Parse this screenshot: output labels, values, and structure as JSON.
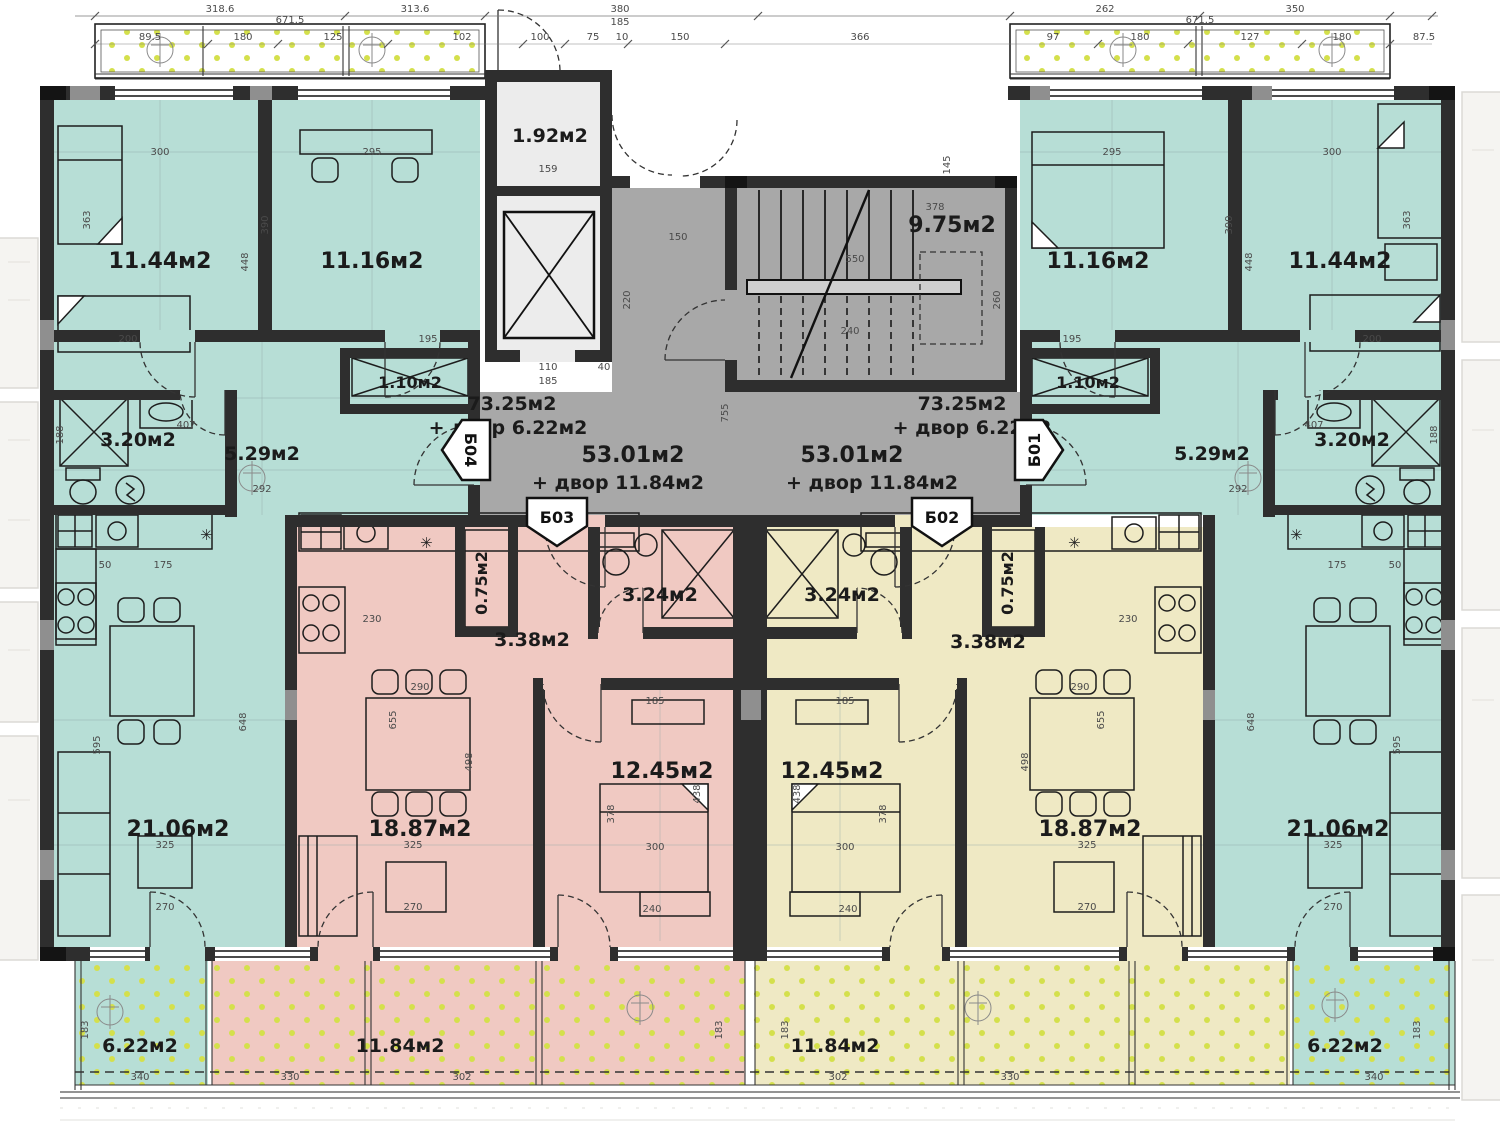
{
  "title": "apartment-floor-plan",
  "colors": {
    "teal_apartment": "#b7ded6",
    "pink_apartment": "#f0c9c2",
    "yellow_apartment": "#efe9c4",
    "common_area_gray": "#a8a8a8",
    "wall": "#2e2e2e",
    "terrace_dot_green": "#d4e04c"
  },
  "rooms": [
    {
      "label": "11.44м2"
    },
    {
      "label": "11.16м2"
    },
    {
      "label": "1.92м2"
    },
    {
      "label": "9.75м2"
    },
    {
      "label": "11.16м2"
    },
    {
      "label": "11.44м2"
    },
    {
      "label": "1.10м2"
    },
    {
      "label": "1.10м2"
    },
    {
      "label": "3.20м2"
    },
    {
      "label": "5.29м2"
    },
    {
      "label": "73.25м2"
    },
    {
      "label": "+ двор 6.22м2"
    },
    {
      "label": "53.01м2"
    },
    {
      "label": "+ двор 11.84м2"
    },
    {
      "label": "53.01м2"
    },
    {
      "label": "+ двор 11.84м2"
    },
    {
      "label": "73.25м2"
    },
    {
      "label": "+ двор 6.22м2"
    },
    {
      "label": "5.29м2"
    },
    {
      "label": "3.20м2"
    },
    {
      "label": "0.75м2"
    },
    {
      "label": "0.75м2"
    },
    {
      "label": "3.24м2"
    },
    {
      "label": "3.24м2"
    },
    {
      "label": "3.38м2"
    },
    {
      "label": "3.38м2"
    },
    {
      "label": "12.45м2"
    },
    {
      "label": "12.45м2"
    },
    {
      "label": "18.87м2"
    },
    {
      "label": "18.87м2"
    },
    {
      "label": "21.06м2"
    },
    {
      "label": "21.06м2"
    },
    {
      "label": "6.22м2"
    },
    {
      "label": "11.84м2"
    },
    {
      "label": "11.84м2"
    },
    {
      "label": "6.22м2"
    }
  ],
  "entrances": [
    {
      "label": "Б04"
    },
    {
      "label": "Б03"
    },
    {
      "label": "Б02"
    },
    {
      "label": "Б01"
    }
  ],
  "dims": [
    {
      "t": "318.6",
      "x": 220,
      "y": 12
    },
    {
      "t": "313.6",
      "x": 415,
      "y": 12
    },
    {
      "t": "380",
      "x": 620,
      "y": 12
    },
    {
      "t": "262",
      "x": 1105,
      "y": 12
    },
    {
      "t": "350",
      "x": 1295,
      "y": 12
    },
    {
      "t": "671.5",
      "x": 290,
      "y": 23
    },
    {
      "t": "185",
      "x": 620,
      "y": 25
    },
    {
      "t": "671.5",
      "x": 1200,
      "y": 23
    },
    {
      "t": "89.5",
      "x": 150,
      "y": 40
    },
    {
      "t": "180",
      "x": 243,
      "y": 40
    },
    {
      "t": "125",
      "x": 333,
      "y": 40
    },
    {
      "t": "102",
      "x": 462,
      "y": 40
    },
    {
      "t": "100",
      "x": 540,
      "y": 40
    },
    {
      "t": "75",
      "x": 593,
      "y": 40
    },
    {
      "t": "10",
      "x": 622,
      "y": 40
    },
    {
      "t": "150",
      "x": 680,
      "y": 40
    },
    {
      "t": "366",
      "x": 860,
      "y": 40
    },
    {
      "t": "97",
      "x": 1053,
      "y": 40
    },
    {
      "t": "180",
      "x": 1140,
      "y": 40
    },
    {
      "t": "127",
      "x": 1250,
      "y": 40
    },
    {
      "t": "180",
      "x": 1342,
      "y": 40
    },
    {
      "t": "87.5",
      "x": 1424,
      "y": 40
    },
    {
      "t": "300",
      "x": 160,
      "y": 155
    },
    {
      "t": "295",
      "x": 372,
      "y": 155
    },
    {
      "t": "295",
      "x": 1112,
      "y": 155
    },
    {
      "t": "300",
      "x": 1332,
      "y": 155
    },
    {
      "t": "363",
      "x": 90,
      "y": 220,
      "r": 1
    },
    {
      "t": "390",
      "x": 268,
      "y": 225,
      "r": 1
    },
    {
      "t": "448",
      "x": 248,
      "y": 262,
      "r": 1
    },
    {
      "t": "448",
      "x": 1252,
      "y": 262,
      "r": 1
    },
    {
      "t": "390",
      "x": 1232,
      "y": 225,
      "r": 1
    },
    {
      "t": "363",
      "x": 1410,
      "y": 220,
      "r": 1
    },
    {
      "t": "200",
      "x": 128,
      "y": 342
    },
    {
      "t": "195",
      "x": 428,
      "y": 342
    },
    {
      "t": "195",
      "x": 1072,
      "y": 342
    },
    {
      "t": "200",
      "x": 1372,
      "y": 342
    },
    {
      "t": "159",
      "x": 548,
      "y": 172
    },
    {
      "t": "145",
      "x": 950,
      "y": 165,
      "r": 1
    },
    {
      "t": "550",
      "x": 855,
      "y": 262
    },
    {
      "t": "240",
      "x": 850,
      "y": 334
    },
    {
      "t": "378",
      "x": 935,
      "y": 210
    },
    {
      "t": "260",
      "x": 1000,
      "y": 300,
      "r": 1
    },
    {
      "t": "150",
      "x": 678,
      "y": 240
    },
    {
      "t": "220",
      "x": 630,
      "y": 300,
      "r": 1
    },
    {
      "t": "110",
      "x": 548,
      "y": 370
    },
    {
      "t": "185",
      "x": 548,
      "y": 384
    },
    {
      "t": "40",
      "x": 604,
      "y": 370
    },
    {
      "t": "755",
      "x": 728,
      "y": 413,
      "r": 1
    },
    {
      "t": "292",
      "x": 262,
      "y": 492
    },
    {
      "t": "292",
      "x": 1238,
      "y": 492
    },
    {
      "t": "407",
      "x": 186,
      "y": 428
    },
    {
      "t": "407",
      "x": 1314,
      "y": 428
    },
    {
      "t": "188",
      "x": 63,
      "y": 435,
      "r": 1
    },
    {
      "t": "188",
      "x": 1437,
      "y": 435,
      "r": 1
    },
    {
      "t": "50",
      "x": 105,
      "y": 568
    },
    {
      "t": "175",
      "x": 163,
      "y": 568
    },
    {
      "t": "230",
      "x": 372,
      "y": 622
    },
    {
      "t": "230",
      "x": 1128,
      "y": 622
    },
    {
      "t": "175",
      "x": 1337,
      "y": 568
    },
    {
      "t": "50",
      "x": 1395,
      "y": 568
    },
    {
      "t": "595",
      "x": 100,
      "y": 745,
      "r": 1
    },
    {
      "t": "648",
      "x": 246,
      "y": 722,
      "r": 1
    },
    {
      "t": "648",
      "x": 1254,
      "y": 722,
      "r": 1
    },
    {
      "t": "595",
      "x": 1400,
      "y": 745,
      "r": 1
    },
    {
      "t": "325",
      "x": 165,
      "y": 848
    },
    {
      "t": "270",
      "x": 165,
      "y": 910
    },
    {
      "t": "325",
      "x": 413,
      "y": 848
    },
    {
      "t": "270",
      "x": 413,
      "y": 910
    },
    {
      "t": "325",
      "x": 1087,
      "y": 848
    },
    {
      "t": "270",
      "x": 1087,
      "y": 910
    },
    {
      "t": "325",
      "x": 1333,
      "y": 848
    },
    {
      "t": "270",
      "x": 1333,
      "y": 910
    },
    {
      "t": "290",
      "x": 420,
      "y": 690
    },
    {
      "t": "290",
      "x": 1080,
      "y": 690
    },
    {
      "t": "655",
      "x": 396,
      "y": 720,
      "r": 1
    },
    {
      "t": "655",
      "x": 1104,
      "y": 720,
      "r": 1
    },
    {
      "t": "498",
      "x": 472,
      "y": 762,
      "r": 1
    },
    {
      "t": "498",
      "x": 1028,
      "y": 762,
      "r": 1
    },
    {
      "t": "185",
      "x": 655,
      "y": 704
    },
    {
      "t": "185",
      "x": 845,
      "y": 704
    },
    {
      "t": "378",
      "x": 614,
      "y": 814,
      "r": 1
    },
    {
      "t": "438",
      "x": 700,
      "y": 794,
      "r": 1
    },
    {
      "t": "438",
      "x": 800,
      "y": 794,
      "r": 1
    },
    {
      "t": "378",
      "x": 886,
      "y": 814,
      "r": 1
    },
    {
      "t": "300",
      "x": 655,
      "y": 850
    },
    {
      "t": "300",
      "x": 845,
      "y": 850
    },
    {
      "t": "240",
      "x": 652,
      "y": 912
    },
    {
      "t": "240",
      "x": 848,
      "y": 912
    },
    {
      "t": "340",
      "x": 140,
      "y": 1080
    },
    {
      "t": "330",
      "x": 290,
      "y": 1080
    },
    {
      "t": "302",
      "x": 462,
      "y": 1080
    },
    {
      "t": "302",
      "x": 838,
      "y": 1080
    },
    {
      "t": "330",
      "x": 1010,
      "y": 1080
    },
    {
      "t": "340",
      "x": 1374,
      "y": 1080
    },
    {
      "t": "183",
      "x": 88,
      "y": 1030,
      "r": 1
    },
    {
      "t": "183",
      "x": 722,
      "y": 1030,
      "r": 1
    },
    {
      "t": "183",
      "x": 788,
      "y": 1030,
      "r": 1
    },
    {
      "t": "183",
      "x": 1420,
      "y": 1030,
      "r": 1
    }
  ]
}
